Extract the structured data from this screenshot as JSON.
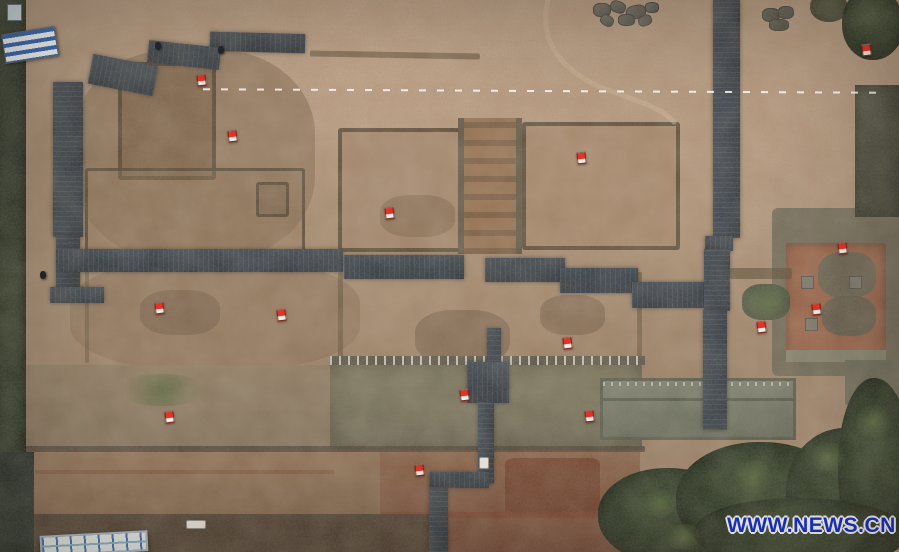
{
  "meta": {
    "description": "Aerial photograph of an archaeological excavation site with dark wooden boardwalks crossing excavated earthen platforms, red survey flags, a white dashed survey line, vegetation along the edges, and a news agency watermark",
    "width": 899,
    "height": 552
  },
  "watermark": {
    "text": "WWW.NEWS.CN",
    "color": "#1733cd",
    "outline": "#ffffff"
  },
  "palette": {
    "ground_tan": "#b0957c",
    "ground_pink": "#c6a98e",
    "pit_brown": "#8a6d52",
    "platform_brown": "#a3846a",
    "axis_red_soil": "#96704f",
    "boardwalk_slate": "#2e3842",
    "wall_dark": "#4e422f",
    "terrace_gray_green": "#767258",
    "bottom_red_soil": "#7a4531",
    "stone_gray": "#85847a",
    "vegetation_dark_green": "#22331f",
    "flag_red": "#e23428",
    "survey_line_white": "#ffffff"
  },
  "flags": [
    {
      "x": 197,
      "y": 74
    },
    {
      "x": 228,
      "y": 130
    },
    {
      "x": 385,
      "y": 207
    },
    {
      "x": 577,
      "y": 152
    },
    {
      "x": 862,
      "y": 44
    },
    {
      "x": 155,
      "y": 302
    },
    {
      "x": 277,
      "y": 309
    },
    {
      "x": 812,
      "y": 303
    },
    {
      "x": 757,
      "y": 321
    },
    {
      "x": 838,
      "y": 242
    },
    {
      "x": 563,
      "y": 337
    },
    {
      "x": 585,
      "y": 410
    },
    {
      "x": 460,
      "y": 389
    },
    {
      "x": 165,
      "y": 411
    },
    {
      "x": 415,
      "y": 464
    }
  ],
  "people": [
    {
      "x": 155,
      "y": 42
    },
    {
      "x": 218,
      "y": 46
    },
    {
      "x": 40,
      "y": 271
    }
  ],
  "white_markers": [
    {
      "x": 479,
      "y": 457,
      "w": 8,
      "h": 10
    },
    {
      "x": 186,
      "y": 520,
      "w": 18,
      "h": 7
    }
  ]
}
